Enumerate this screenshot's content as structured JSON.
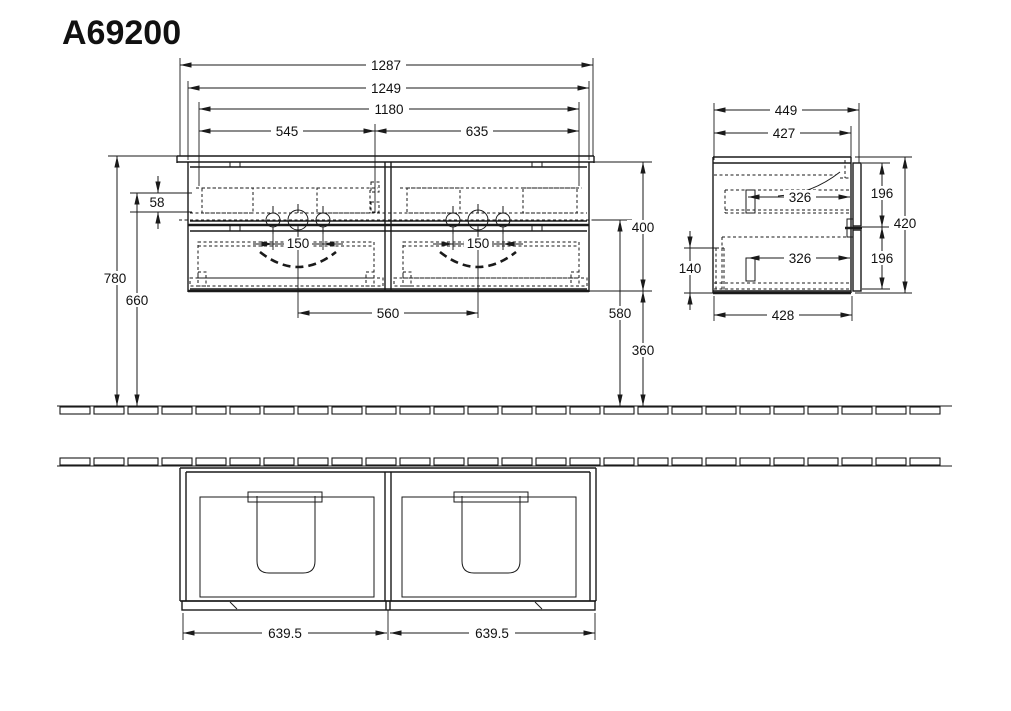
{
  "title": "A69200",
  "colors": {
    "line": "#1a1a1a",
    "background": "#ffffff"
  },
  "front": {
    "w1287": "1287",
    "w1249": "1249",
    "w1180": "1180",
    "w545": "545",
    "w635": "635",
    "h58": "58",
    "h780": "780",
    "h660": "660",
    "h400": "400",
    "h580": "580",
    "h360": "360",
    "tap150_left": "150",
    "tap150_right": "150",
    "centers560": "560"
  },
  "side": {
    "d449": "449",
    "d427": "427",
    "d428": "428",
    "i326_top": "326",
    "i326_bottom": "326",
    "h196_top": "196",
    "h196_bottom": "196",
    "h420": "420",
    "rail140": "140"
  },
  "plan": {
    "left6395": "639.5",
    "right6395": "639.5"
  }
}
